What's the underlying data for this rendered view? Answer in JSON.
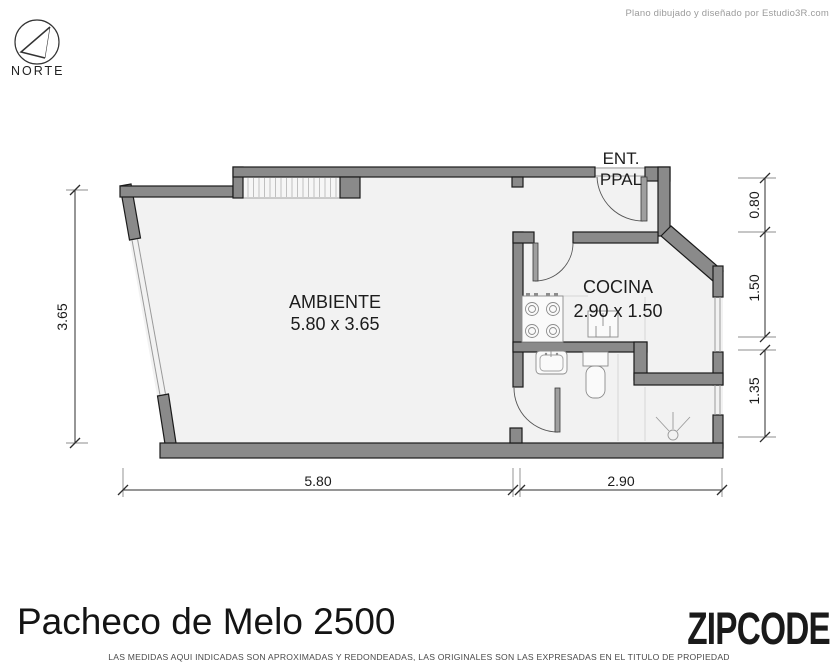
{
  "credit": "Plano dibujado y diseñado por Estudio3R.com",
  "compass": {
    "label": "NORTE"
  },
  "entrance": {
    "line1": "ENT.",
    "line2": "PPAL"
  },
  "rooms": {
    "ambiente": {
      "name": "AMBIENTE",
      "dims": "5.80 x 3.65"
    },
    "cocina": {
      "name": "COCINA",
      "dims": "2.90 x 1.50"
    }
  },
  "dimensions": {
    "left": "3.65",
    "right": [
      "0.80",
      "1.50",
      "1.35"
    ],
    "bottom": [
      "5.80",
      "2.90"
    ]
  },
  "fixtures": [
    "stove-icon",
    "kitchen-sink-icon",
    "bathroom-sink-icon",
    "toilet-icon",
    "shower-icon"
  ],
  "footer": {
    "address": "Pacheco de Melo 2500",
    "brand": "ZIPCODE",
    "disclaimer": "LAS MEDIDAS AQUI INDICADAS SON APROXIMADAS Y REDONDEADAS, LAS ORIGINALES SON LAS EXPRESADAS EN EL TITULO DE PROPIEDAD"
  },
  "colors": {
    "wall": "#8a8a8a",
    "floor": "#f2f2f2",
    "outline": "#1b1b1b",
    "accent_gray": "#9b9b9b"
  }
}
